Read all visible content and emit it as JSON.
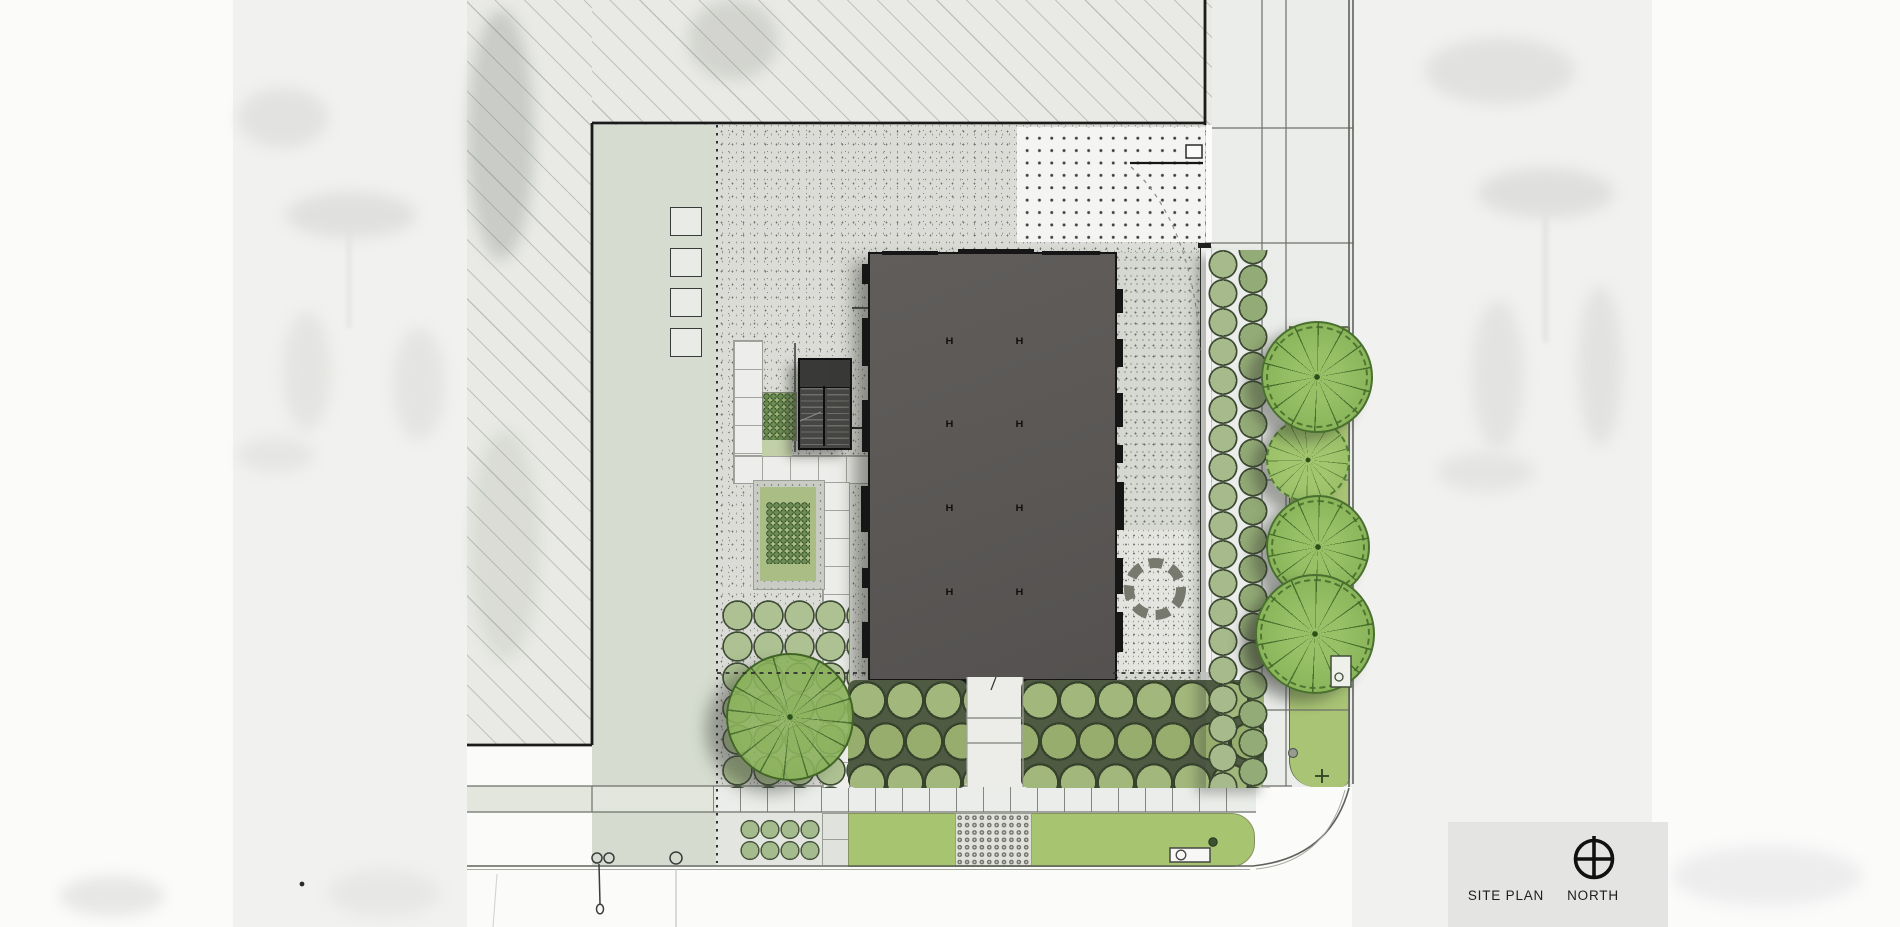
{
  "drawing": {
    "type": "architectural-site-plan",
    "title_block": {
      "site_plan_label": "SITE PLAN",
      "north_label": "NORTH"
    },
    "building": {
      "column_marker": "H",
      "column_grid": {
        "columns": 2,
        "rows": 4
      }
    },
    "palette": {
      "building_fill": "#5a5755",
      "outline": "#141414",
      "hatch_area": "#e9eae6",
      "lawn": "#d6ddd0",
      "bright_lawn": "#a7c471",
      "gravel_stipple": "#dbdcd7",
      "paver_white": "#edeeeb",
      "shrub_green": "#a2b77b",
      "tree_green": "#8ab55a",
      "shadow": "rgba(55,57,50,0.5)"
    },
    "elements": [
      {
        "name": "existing-building-hatched",
        "kind": "adjacent-structure"
      },
      {
        "name": "proposed-building",
        "kind": "building-footprint"
      },
      {
        "name": "stair-annex",
        "kind": "stair"
      },
      {
        "name": "entry-walk-with-steps",
        "kind": "path"
      },
      {
        "name": "sunken-planters",
        "kind": "planting"
      },
      {
        "name": "seat-ring",
        "kind": "site-furniture"
      },
      {
        "name": "hedge-row-east",
        "kind": "planting"
      },
      {
        "name": "street-trees-east",
        "count": 5,
        "kind": "tree"
      },
      {
        "name": "lawn-tree",
        "count": 1,
        "kind": "tree"
      },
      {
        "name": "shrub-masses-south",
        "kind": "planting"
      },
      {
        "name": "dotted-paver-plaza",
        "kind": "paving"
      },
      {
        "name": "tactile-paver-panel",
        "kind": "paving"
      },
      {
        "name": "parkway-strip",
        "kind": "planting"
      },
      {
        "name": "bench",
        "kind": "site-furniture"
      },
      {
        "name": "north-arrow",
        "kind": "symbol"
      }
    ]
  }
}
